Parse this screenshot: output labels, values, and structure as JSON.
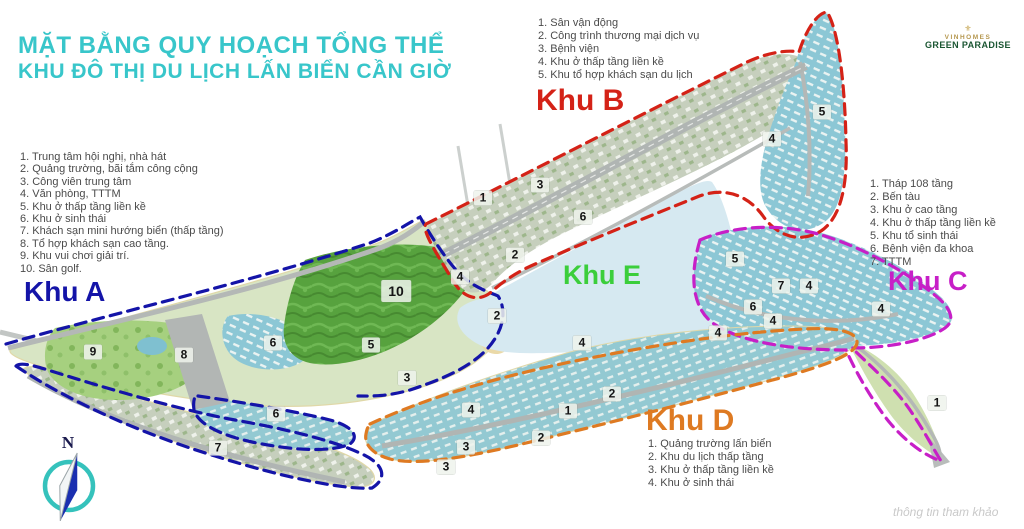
{
  "title": {
    "line1": "MẶT BẰNG QUY HOẠCH TỔNG THỂ",
    "line2": "KHU ĐÔ THỊ DU LỊCH LẤN BIỂN CẦN GIỜ",
    "color": "#38c6ca"
  },
  "logo": {
    "brand": "VINHOMES",
    "name": "GREEN PARADISE",
    "icon": "gold-crest-icon"
  },
  "compass": {
    "label": "N"
  },
  "watermark": "thông tin tham khảo",
  "zones": {
    "A": {
      "label": "Khu A",
      "color": "#1414a8",
      "items": [
        "Trung tâm hội nghị, nhà hát",
        "Quảng trường, bãi tắm công cộng",
        "Công viên trung tâm",
        "Văn phòng, TTTM",
        "Khu ở thấp tầng liền kề",
        "Khu ở sinh thái",
        "Khách sạn mini hướng biển (thấp tầng)",
        "Tổ hợp khách sạn cao tầng.",
        "Khu vui chơi giải trí.",
        "Sân golf."
      ]
    },
    "B": {
      "label": "Khu B",
      "color": "#d42217",
      "items": [
        "Sân vận động",
        "Công trình thương mại dịch vụ",
        "Bệnh viện",
        "Khu ở thấp tầng liền kề",
        "Khu tổ hợp khách sạn du lịch"
      ]
    },
    "C": {
      "label": "Khu C",
      "color": "#c71fc7",
      "items": [
        "Tháp 108 tầng",
        "Bến tàu",
        "Khu ở cao tầng",
        "Khu ở thấp tầng liền kề",
        "Khu tổ sinh thái",
        "Bệnh viện đa khoa",
        "TTTM"
      ]
    },
    "D": {
      "label": "Khu D",
      "color": "#de7a22",
      "items": [
        "Quảng trường lấn biển",
        "Khu du lịch thấp tầng",
        "Khu ở thấp tầng liền kề",
        "Khu ở sinh thái"
      ]
    },
    "E": {
      "label": "Khu E",
      "color": "#3bce3b",
      "items": []
    }
  },
  "map": {
    "colors": {
      "sea": "#ffffff",
      "lake": "#d6e9f1",
      "land": "#d8e5c4",
      "road": "#b4b8b6",
      "golf": "#57a23e",
      "park": "#a6d07f",
      "residential": "#8cc7d5"
    },
    "markers": [
      {
        "zone": "A",
        "n": "9",
        "x": 93,
        "y": 352
      },
      {
        "zone": "A",
        "n": "8",
        "x": 184,
        "y": 355
      },
      {
        "zone": "A",
        "n": "10",
        "x": 396,
        "y": 291
      },
      {
        "zone": "A",
        "n": "6",
        "x": 273,
        "y": 343
      },
      {
        "zone": "A",
        "n": "6",
        "x": 276,
        "y": 414
      },
      {
        "zone": "A",
        "n": "7",
        "x": 218,
        "y": 448
      },
      {
        "zone": "A",
        "n": "5",
        "x": 371,
        "y": 345
      },
      {
        "zone": "A",
        "n": "3",
        "x": 407,
        "y": 378
      },
      {
        "zone": "A",
        "n": "2",
        "x": 515,
        "y": 255
      },
      {
        "zone": "A",
        "n": "2",
        "x": 497,
        "y": 316
      },
      {
        "zone": "A",
        "n": "4",
        "x": 460,
        "y": 277
      },
      {
        "zone": "B",
        "n": "1",
        "x": 483,
        "y": 198
      },
      {
        "zone": "B",
        "n": "3",
        "x": 540,
        "y": 185
      },
      {
        "zone": "B",
        "n": "6",
        "x": 583,
        "y": 217
      },
      {
        "zone": "B",
        "n": "4",
        "x": 772,
        "y": 139
      },
      {
        "zone": "B",
        "n": "5",
        "x": 822,
        "y": 112
      },
      {
        "zone": "C",
        "n": "5",
        "x": 735,
        "y": 259
      },
      {
        "zone": "C",
        "n": "7",
        "x": 781,
        "y": 286
      },
      {
        "zone": "C",
        "n": "6",
        "x": 753,
        "y": 307
      },
      {
        "zone": "C",
        "n": "4",
        "x": 809,
        "y": 286
      },
      {
        "zone": "C",
        "n": "4",
        "x": 773,
        "y": 321
      },
      {
        "zone": "C",
        "n": "4",
        "x": 718,
        "y": 333
      },
      {
        "zone": "C",
        "n": "4",
        "x": 881,
        "y": 309
      },
      {
        "zone": "C",
        "n": "1",
        "x": 937,
        "y": 403
      },
      {
        "zone": "D",
        "n": "4",
        "x": 582,
        "y": 343
      },
      {
        "zone": "D",
        "n": "2",
        "x": 612,
        "y": 394
      },
      {
        "zone": "D",
        "n": "1",
        "x": 568,
        "y": 411
      },
      {
        "zone": "D",
        "n": "4",
        "x": 471,
        "y": 410
      },
      {
        "zone": "D",
        "n": "2",
        "x": 541,
        "y": 438
      },
      {
        "zone": "D",
        "n": "3",
        "x": 466,
        "y": 447
      },
      {
        "zone": "D",
        "n": "3",
        "x": 446,
        "y": 467
      }
    ]
  }
}
